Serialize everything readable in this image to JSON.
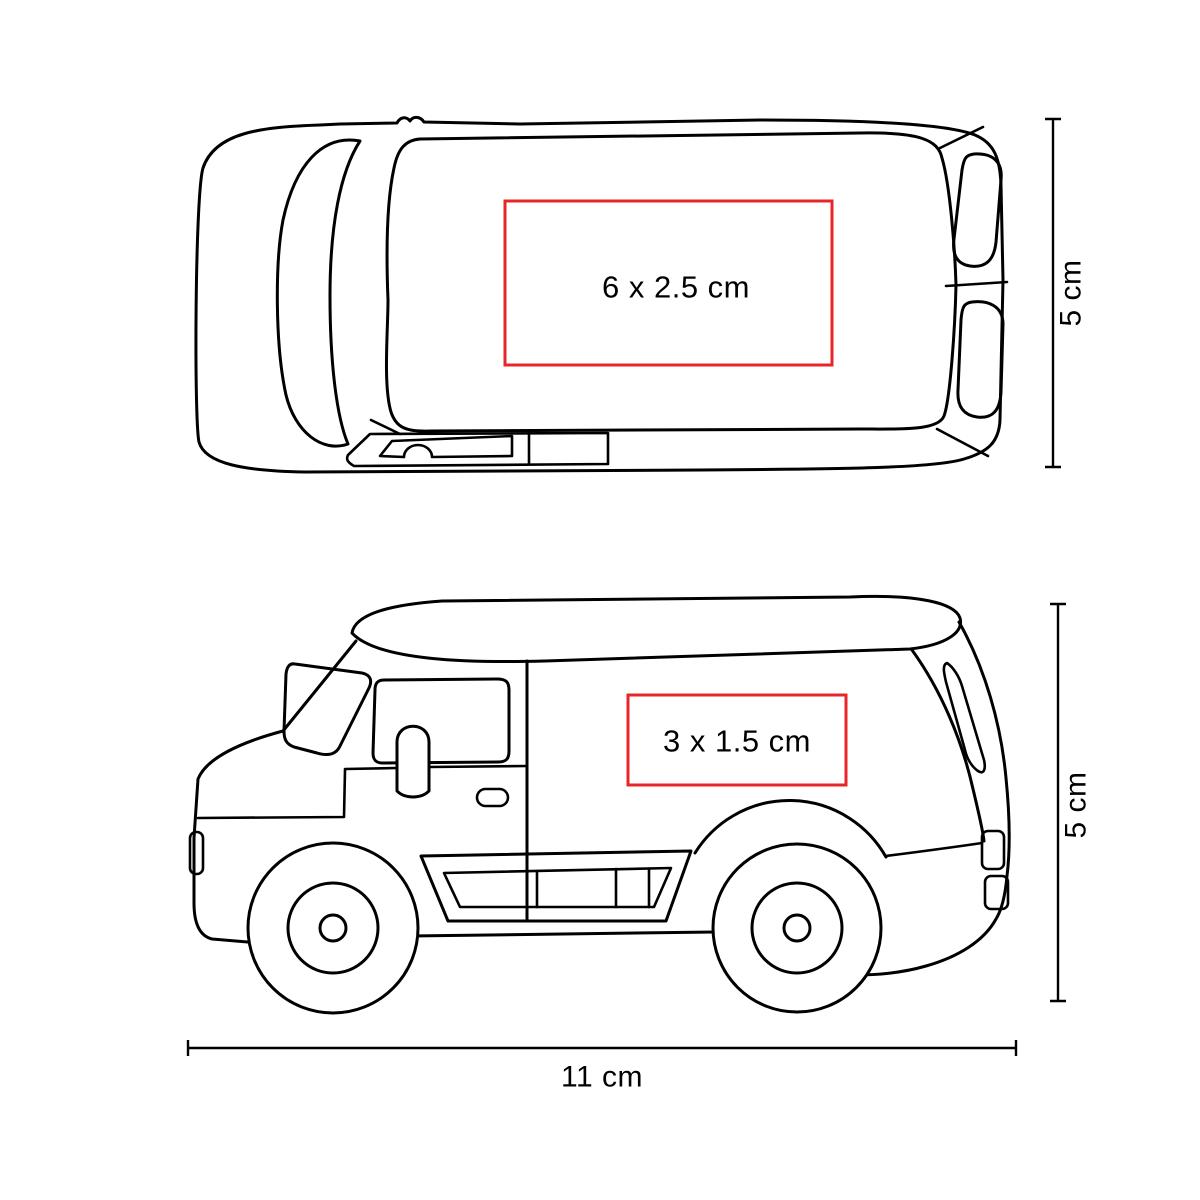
{
  "colors": {
    "line": "#000000",
    "print_area": "#e8262a",
    "label": "#000000"
  },
  "diagram": {
    "title": "van-print-area-specification",
    "views": {
      "top": {
        "name": "van top view",
        "print_area_label": "6 x 2.5 cm",
        "height_dimension_label": "5 cm"
      },
      "side": {
        "name": "van side view",
        "print_area_label": "3 x 1.5 cm",
        "height_dimension_label": "5 cm",
        "length_dimension_label": "11 cm"
      }
    }
  }
}
